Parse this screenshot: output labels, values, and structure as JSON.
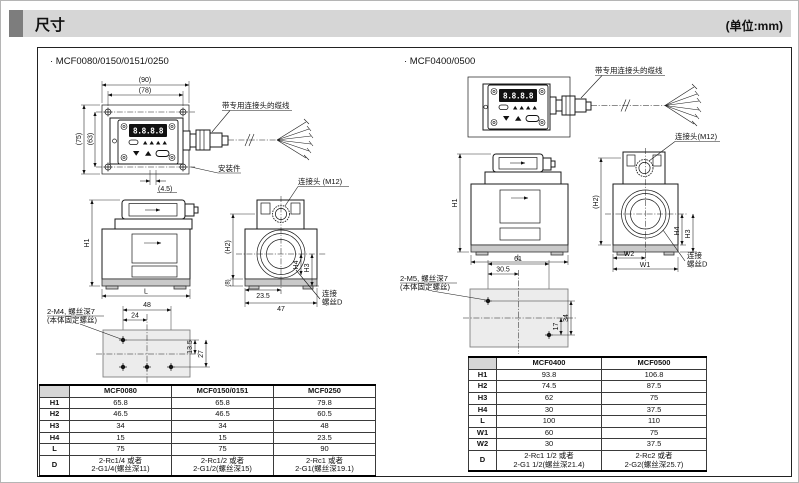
{
  "header": {
    "title": "尺寸",
    "unit": "(单位:mm)"
  },
  "panel": {
    "digits": "8.8.8.8"
  },
  "labels": {
    "cable": "带专用连接头的缆线",
    "mount": "安装件",
    "connector_left": "连接头 (M12)",
    "connector_right": "连接头(M12)",
    "conn_screw_line1": "连接",
    "conn_screw_line2": "螺丝D",
    "m4_note": "2-M4, 螺丝深7",
    "m5_note": "2-M5, 螺丝深7",
    "fix_note": "(本体固定螺丝)"
  },
  "dims": {
    "d90": "(90)",
    "d78": "(78)",
    "d75": "(75)",
    "d63": "(63)",
    "d45": "(4.5)",
    "h1": "H1",
    "h2": "(H2)",
    "h3": "H3",
    "h4": "H4",
    "l": "L",
    "d8": "(8)",
    "d235": "23.5",
    "d47": "47",
    "d48": "48",
    "d24": "24",
    "d135": "13.5",
    "d27": "27",
    "d61": "61",
    "d305": "30.5",
    "d17": "17",
    "d34": "34",
    "w1": "W1",
    "w2": "W2"
  },
  "left": {
    "title": "· MCF0080/0150/0151/0250",
    "table": {
      "corner": "",
      "headers": [
        "MCF0080",
        "MCF0150/0151",
        "MCF0250"
      ],
      "rows": [
        {
          "label": "H1",
          "v": [
            "65.8",
            "65.8",
            "79.8"
          ]
        },
        {
          "label": "H2",
          "v": [
            "46.5",
            "46.5",
            "60.5"
          ]
        },
        {
          "label": "H3",
          "v": [
            "34",
            "34",
            "48"
          ]
        },
        {
          "label": "H4",
          "v": [
            "15",
            "15",
            "23.5"
          ]
        },
        {
          "label": "L",
          "v": [
            "75",
            "75",
            "90"
          ]
        },
        {
          "label": "D",
          "v": [
            "2-Rc1/4 或者\n2-G1/4(螺丝深11)",
            "2-Rc1/2 或者\n2-G1/2(螺丝深15)",
            "2-Rc1 或者\n2-G1(螺丝深19.1)"
          ]
        }
      ]
    }
  },
  "right": {
    "title": "· MCF0400/0500",
    "table": {
      "corner": "",
      "headers": [
        "MCF0400",
        "MCF0500"
      ],
      "rows": [
        {
          "label": "H1",
          "v": [
            "93.8",
            "106.8"
          ]
        },
        {
          "label": "H2",
          "v": [
            "74.5",
            "87.5"
          ]
        },
        {
          "label": "H3",
          "v": [
            "62",
            "75"
          ]
        },
        {
          "label": "H4",
          "v": [
            "30",
            "37.5"
          ]
        },
        {
          "label": "L",
          "v": [
            "100",
            "110"
          ]
        },
        {
          "label": "W1",
          "v": [
            "60",
            "75"
          ]
        },
        {
          "label": "W2",
          "v": [
            "30",
            "37.5"
          ]
        },
        {
          "label": "D",
          "v": [
            "2-Rc1 1/2 或者\n2-G1 1/2(螺丝深21.4)",
            "2-Rc2 或者\n2-G2(螺丝深25.7)"
          ]
        }
      ]
    }
  }
}
